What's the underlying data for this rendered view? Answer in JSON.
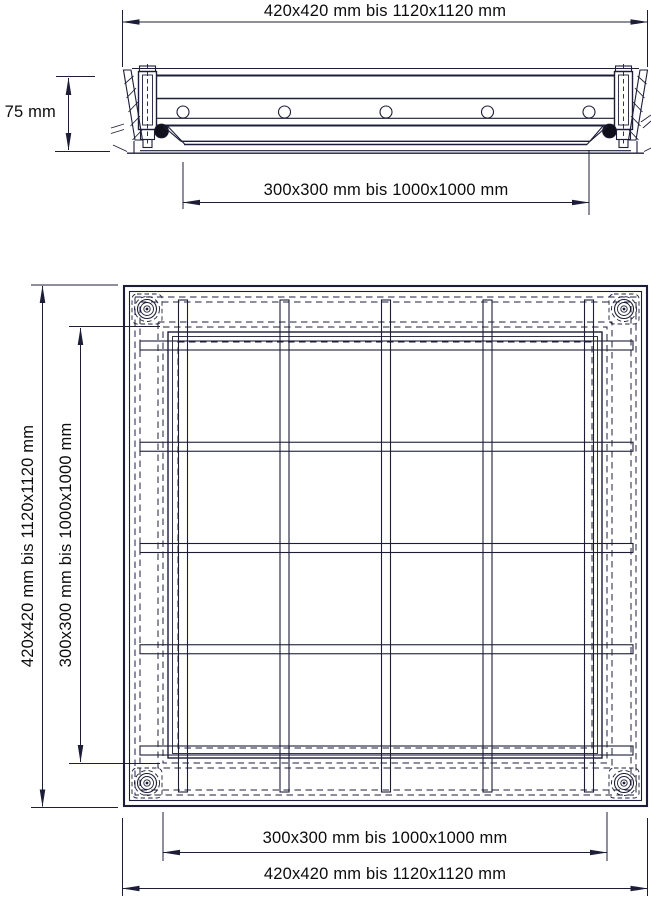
{
  "meta": {
    "type": "technical-drawing",
    "subject": "Floor access cover (Schachtabdeckung) – sectional view and plan view with size ranges"
  },
  "colors": {
    "line": "#1d1d38",
    "text": "#0c0c0c",
    "background": "#ffffff",
    "seal": "#10101c"
  },
  "dimension_labels": {
    "section_top_outer": "420x420 mm bis 1120x1120 mm",
    "section_height": "75 mm",
    "section_clear_opening": "300x300 mm bis 1000x1000 mm",
    "plan_left_outer": "420x420 mm bis 1120x1120 mm",
    "plan_left_inner": "300x300 mm bis 1000x1000 mm",
    "plan_bottom_inner": "300x300 mm bis 1000x1000 mm",
    "plan_bottom_outer": "420x420 mm bis 1120x1120 mm"
  },
  "dimension_values": {
    "outer_frame_size_range_mm": "420x420 bis 1120x1120",
    "clear_opening_size_range_mm": "300x300 bis 1000x1000",
    "frame_height_mm": 75
  }
}
